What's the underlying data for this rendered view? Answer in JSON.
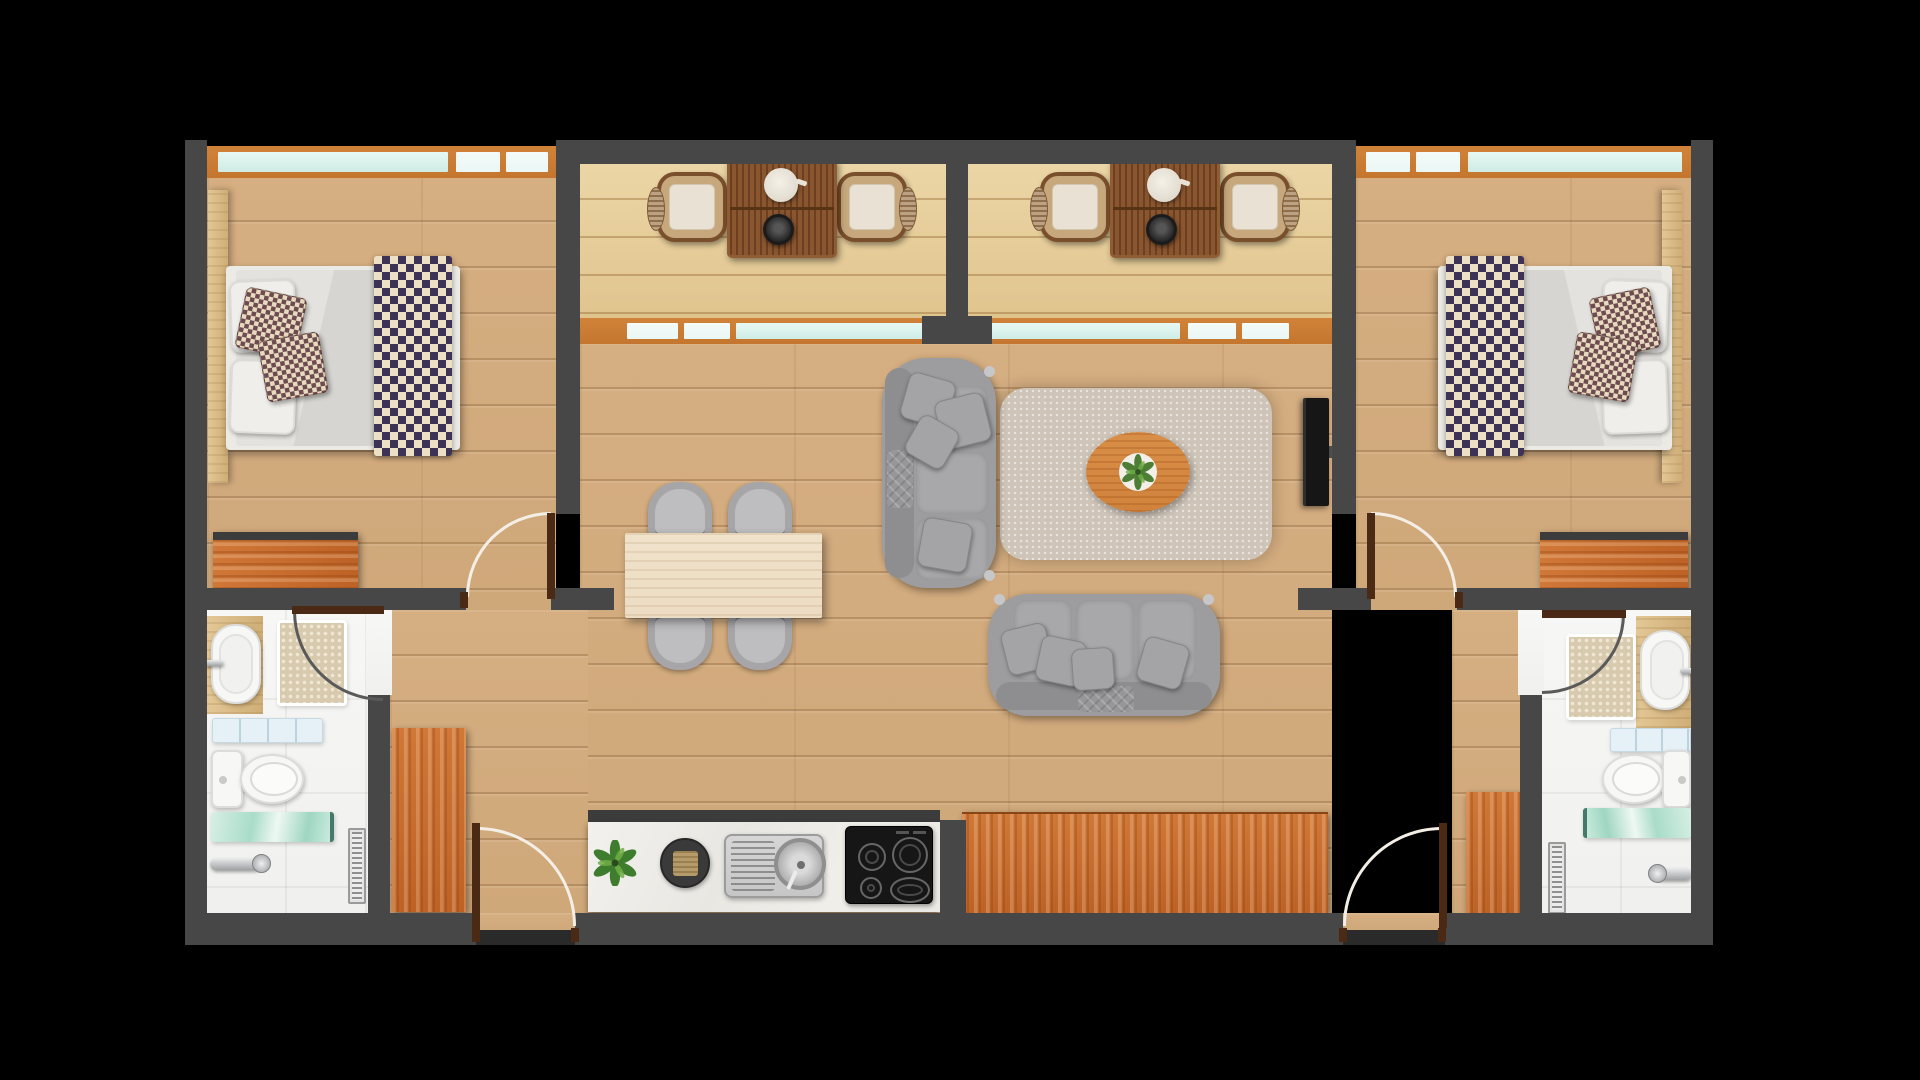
{
  "scene": {
    "type": "architectural-floor-plan",
    "view": "top-down 3d render",
    "description": "Symmetric two-bedroom apartment floor plan on black background: two bedrooms with double beds (left and right), two balconies with tea tables at top-center, open living-dining room with sofas, rug and TV in the center, linear kitchen and wood sideboard along the bottom, and two mirrored bathrooms at the lower corners."
  },
  "palette": {
    "background": "#000000",
    "wall": "#474747",
    "wallDark": "#2a2a2a",
    "doorWood": "#4a2a14",
    "swingArcLight": "#f4efe6",
    "swingArcDark": "#5a5a5a",
    "floorOak": "#cfa87a",
    "balconyDeck": "#e0c48e",
    "windowFrame": "#c4762f",
    "windowGlass": "#cfece6",
    "windowGlassPale": "#eaf7f4",
    "bathroomTile": "#f0f0ee",
    "kitchenCounter": "#f0eee9",
    "cabinetOrange": "#bd6226",
    "sofaGray": "#9d9da0",
    "rugGreige": "#cec4b8",
    "coffeeTableWood": "#d0823b",
    "diningTableWood": "#ecdcc3",
    "chairGray": "#a6a6a9",
    "bedDuvet": "#d6d5d1",
    "throwDark": "#3e3354",
    "throwCream": "#ece1c6",
    "plantGreen": "#4e7d35",
    "applianceBlack": "#161616",
    "steel": "#c6c6c6"
  },
  "rooms": [
    {
      "id": "bedroom-left",
      "contents": [
        "window-band",
        "headboard-panel",
        "double-bed",
        "white-pillows",
        "checkered-cushions",
        "checkered-throw-runner",
        "dresser"
      ]
    },
    {
      "id": "bedroom-right",
      "contents": [
        "window-band",
        "headboard-panel",
        "double-bed",
        "white-pillows",
        "checkered-cushions",
        "checkered-throw-runner",
        "dresser"
      ]
    },
    {
      "id": "balcony-left",
      "contents": [
        "slatted-tea-table",
        "teapot",
        "kettle",
        "armchair",
        "armchair",
        "window-band"
      ]
    },
    {
      "id": "balcony-right",
      "contents": [
        "slatted-tea-table",
        "teapot",
        "kettle",
        "armchair",
        "armchair",
        "window-band"
      ]
    },
    {
      "id": "living-dining-room",
      "contents": [
        "three-seat-sofa-vertical",
        "three-seat-sofa-horizontal",
        "area-rug",
        "oval-coffee-table",
        "potted-plant",
        "wall-mounted-tv",
        "dining-table",
        "dining-chairs-x4"
      ]
    },
    {
      "id": "kitchen",
      "contents": [
        "marble-counter",
        "upper-cabinet-edge",
        "potted-plant",
        "serving-tray",
        "steel-sink",
        "four-burner-cooktop",
        "sideboard"
      ]
    },
    {
      "id": "hallway-left",
      "contents": [
        "wardrobe",
        "entry-door"
      ]
    },
    {
      "id": "hallway-right",
      "contents": [
        "wardrobe",
        "entry-door"
      ]
    },
    {
      "id": "bathroom-left",
      "contents": [
        "vanity-sink",
        "shower-mat",
        "swing-door",
        "frosted-shelf",
        "toilet",
        "glass-shelf",
        "towel-bar",
        "floor-drain"
      ]
    },
    {
      "id": "bathroom-right",
      "contents": [
        "vanity-sink",
        "shower-mat",
        "swing-door",
        "frosted-shelf",
        "toilet",
        "glass-shelf",
        "towel-bar",
        "floor-drain"
      ]
    }
  ]
}
